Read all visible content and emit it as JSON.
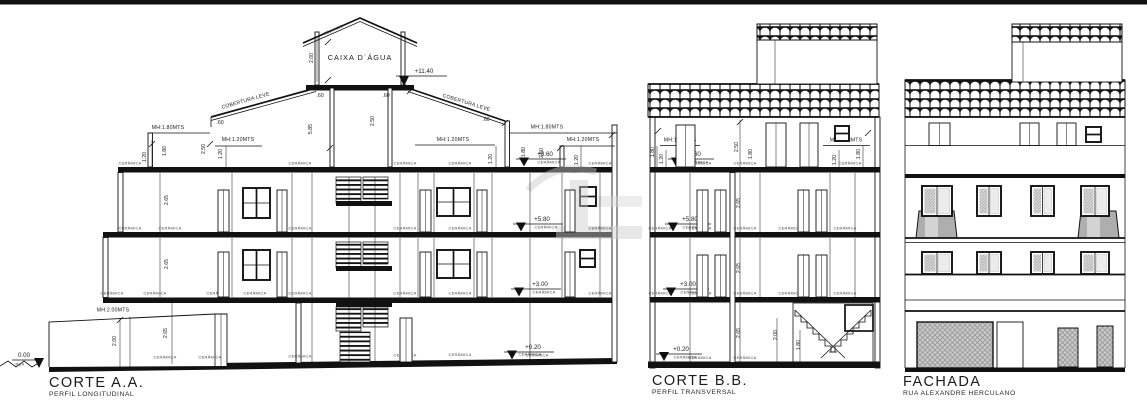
{
  "page": {
    "background": "#ffffff",
    "top_border_color": "#000000",
    "line_color": "#111111"
  },
  "titles": {
    "corte_aa": {
      "title": "CORTE A.A.",
      "subtitle": "PERFIL LONGITUDINAL"
    },
    "corte_bb": {
      "title": "CORTE B.B.",
      "subtitle": "PERFIL TRANSVERSAL"
    },
    "fachada": {
      "title": "FACHADA",
      "subtitle": "RUA ALEXANDRE HERCULANO"
    }
  },
  "labels": {
    "ceramica": "CERÂMICA",
    "mh120": "MH:1.20MTS",
    "mh180": "MH:1.80MTS",
    "mh200": "MH:2.00MTS",
    "cobertura_leve": "COBERTURA LEVE",
    "telhado": "TELHADO",
    "caixa_dagua": "CAIXA D´ÁGUA",
    "rua": "RUA"
  },
  "elevations": {
    "top": "+11.40",
    "roof": "+8.60",
    "third": "+5.80",
    "second": "+3.00",
    "ground": "+0.20",
    "street": "0.00"
  },
  "dims": {
    "d060": ".60",
    "d120": "1.20",
    "d180": "1.80",
    "d200": "2.00",
    "d250": "2.50",
    "d265": "2.65",
    "d585": "5.85"
  }
}
